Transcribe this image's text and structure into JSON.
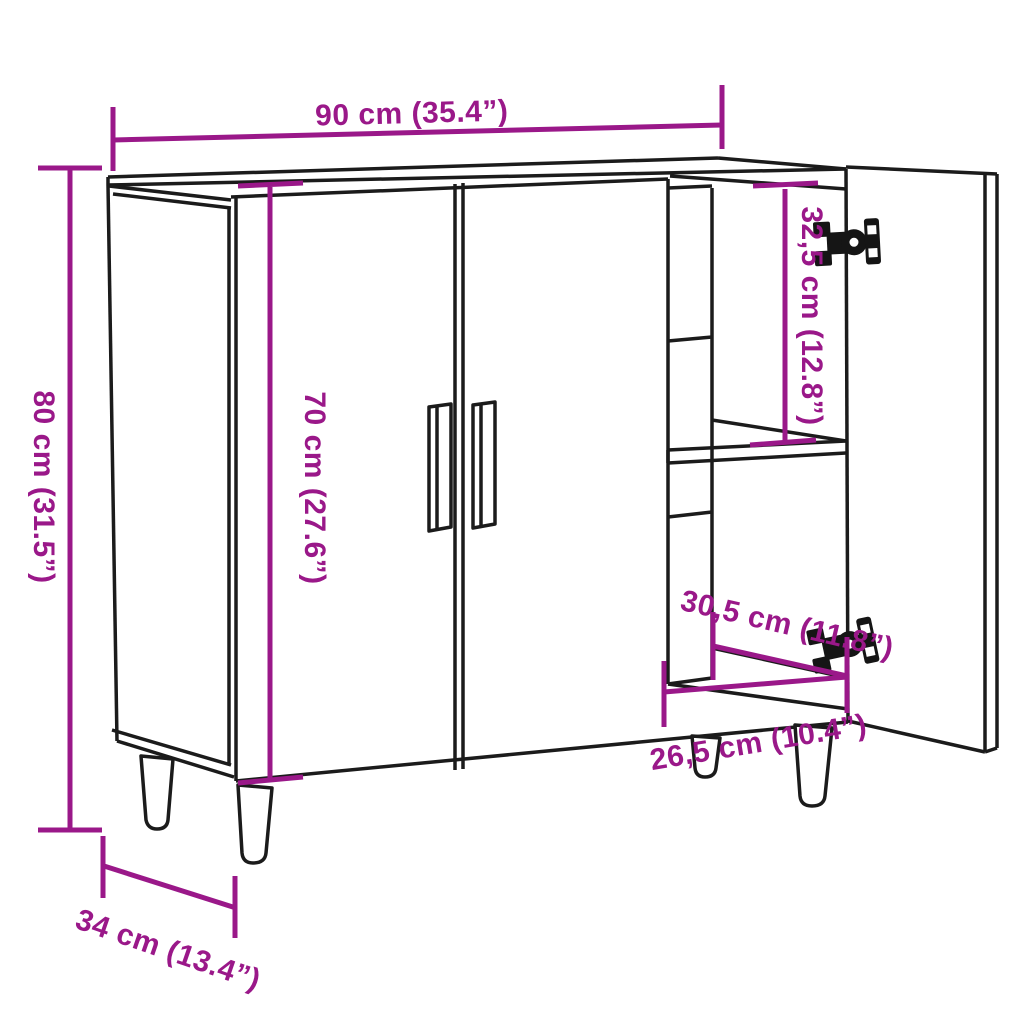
{
  "diagram": {
    "colors": {
      "dimension_accent": "#9A1889",
      "outline": "#1b1b1b",
      "background": "#ffffff"
    },
    "dimensions": {
      "overall_width": "90 cm (35.4”)",
      "overall_height": "80 cm (31.5”)",
      "door_height": "70 cm (27.6”)",
      "upper_compartment_height": "32,5 cm (12.8”)",
      "compartment_depth": "30,5 cm (11.8”)",
      "compartment_width": "26,5 cm (10.4”)",
      "overall_depth": "34 cm (13.4”)"
    }
  }
}
